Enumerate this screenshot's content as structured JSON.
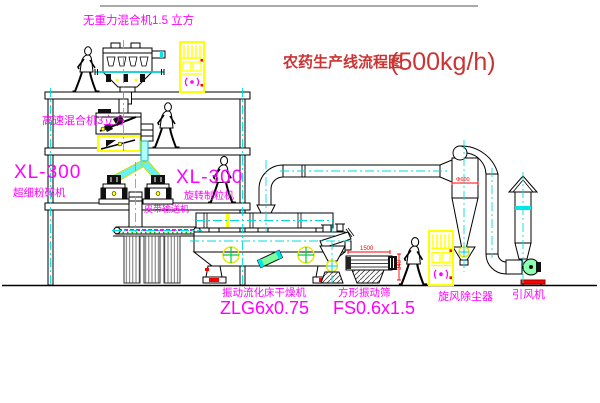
{
  "title": {
    "name_zh": "农药生产线流程图",
    "capacity": "(500kg/h)"
  },
  "equipment_labels": {
    "top_mixer": "无重力混合机1.5 立方",
    "high_speed_mixer": "高速混合机3立方",
    "mill": {
      "model": "XL-300",
      "name": "超细粉碎机"
    },
    "granulator": {
      "model": "XL-300",
      "name": "旋转制粒机"
    },
    "belt_conveyor": "皮带输送机",
    "dryer": {
      "name": "振动流化床干燥机",
      "model": "ZLG6x0.75"
    },
    "sieve": {
      "name": "方形振动筛",
      "model": "FS0.6x1.5"
    },
    "cyclone": "旋风除尘器",
    "fan": "引风机"
  },
  "dimensions": {
    "sieve_length": "1500",
    "sieve_height": "340",
    "cyclone_diameter": "Φ600"
  },
  "colors": {
    "label_magenta": "#ff00ff",
    "title_red": "#cc3333",
    "dimension_red": "#ff0000",
    "centerline_cyan": "#00dddd",
    "highlight_yellow": "#ffff00",
    "machine_green": "#7dff9d",
    "line_black": "#000000"
  }
}
